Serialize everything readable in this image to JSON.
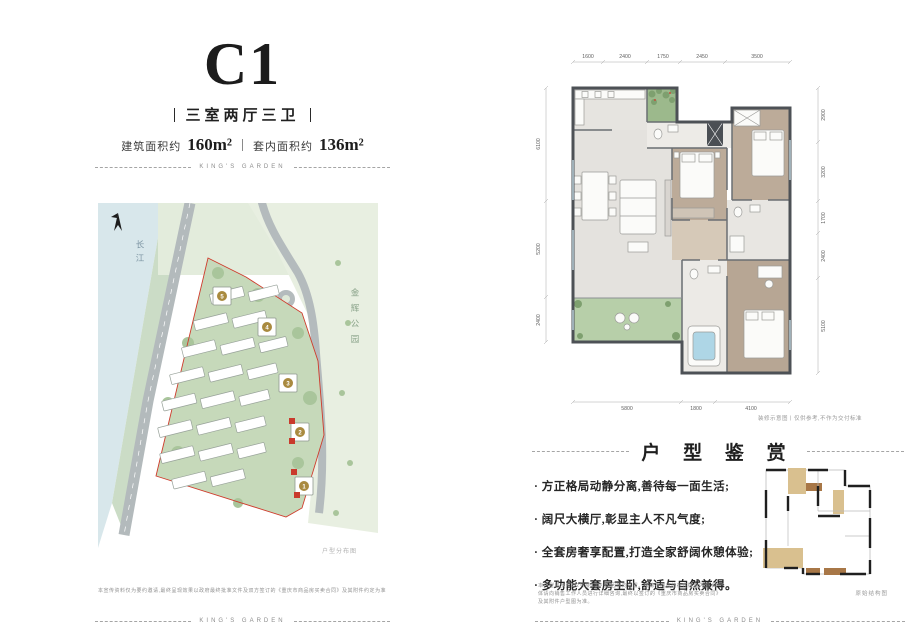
{
  "brand": {
    "divider_text": "KING'S GARDEN"
  },
  "header": {
    "unit_name": "C1",
    "layout_subtitle": "三室两厅三卫",
    "area": {
      "build_label": "建筑面积约",
      "build_value": "160m²",
      "inner_label": "套内面积约",
      "inner_value": "136m²"
    }
  },
  "site_map": {
    "river_label": "长江",
    "park_label": "金辉公园",
    "caption": "户型分布图",
    "building_badges": [
      "5",
      "4",
      "3",
      "2",
      "1"
    ]
  },
  "left_disclaimer": "本宣传资料仅为要约邀请,最终呈现效果以政府最终批准文件及双方签订的《重庆市商品房买卖合同》及其附件约定为准",
  "floorplan": {
    "dims_top": [
      "1600",
      "2400",
      "1750",
      "2450",
      "3500"
    ],
    "dims_bottom": [
      "5800",
      "1800",
      "4100"
    ],
    "dims_left": [
      "6100",
      "5200",
      "2400"
    ],
    "dims_right": [
      "2900",
      "3200",
      "1700",
      "2400",
      "5100"
    ],
    "caption": "装修示意图丨仅供参考,不作为交付标准"
  },
  "appreciation": {
    "title": "户 型 鉴 赏",
    "bullets": [
      "· 方正格局动静分离,善待每一面生活;",
      "· 阔尺大横厅,彰显主人不凡气度;",
      "· 全套房奢享配置,打造全家舒阔休憩体验;",
      "· 多功能大套房主卧,舒适与自然兼得。"
    ],
    "disclaimer": "本户型展示为1/2号楼C1户型,因朝向位置、楼栋不同可能存在镜像户型,具体请向销售工作人员进行详细咨询,最终以签订的《重庆市商品房买卖合同》及其附件户型图为准。",
    "structure_caption": "原始结构图"
  }
}
